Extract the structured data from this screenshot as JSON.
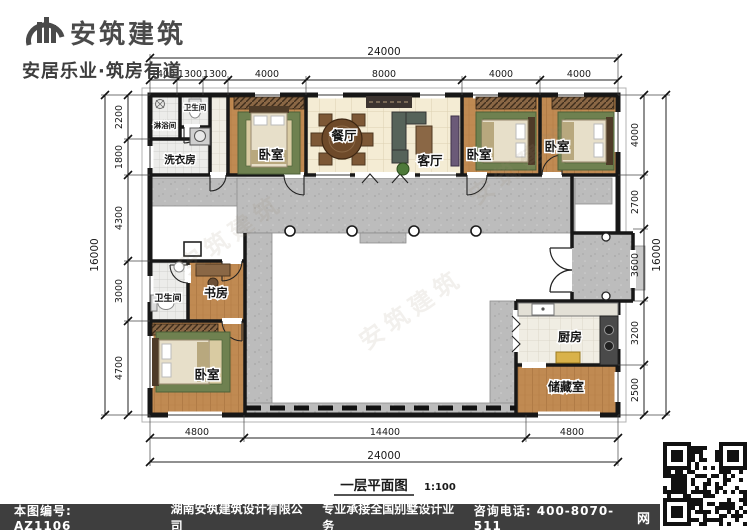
{
  "header": {
    "brand": "安筑建筑",
    "slogan": "安居乐业·筑房有道"
  },
  "plan": {
    "rooms": {
      "shower": "淋浴间",
      "wc_top": "卫生间",
      "laundry": "洗衣房",
      "bedroom1": "卧室",
      "dining": "餐厅",
      "living": "客厅",
      "bedroom2": "卧室",
      "bedroom3": "卧室",
      "study": "书房",
      "wc_left": "卫生间",
      "bedroom4": "卧室",
      "kitchen": "厨房",
      "storage": "储藏室"
    },
    "dimensions": {
      "top_total": "24000",
      "top_segments": [
        "1400",
        "1300",
        "1300",
        "4000",
        "8000",
        "4000",
        "4000"
      ],
      "bottom_total": "24000",
      "bottom_segments": [
        "4800",
        "14400",
        "4800"
      ],
      "left_total": "16000",
      "left_segments": [
        "2200",
        "1800",
        "4300",
        "3000",
        "4700"
      ],
      "right_total": "16000",
      "right_segments": [
        "4000",
        "2700",
        "3600",
        "3200",
        "2500"
      ]
    },
    "caption": {
      "title": "一层平面图",
      "scale": "1:100"
    },
    "watermark": "安筑建筑"
  },
  "footer": {
    "drawing_no": "本图编号: AZ1106",
    "company": "湖南安筑建筑设计有限公司",
    "service": "专业承接全国别墅设计业务",
    "phone": "咨询电话: 400-8070-511",
    "qr_label": "网"
  }
}
